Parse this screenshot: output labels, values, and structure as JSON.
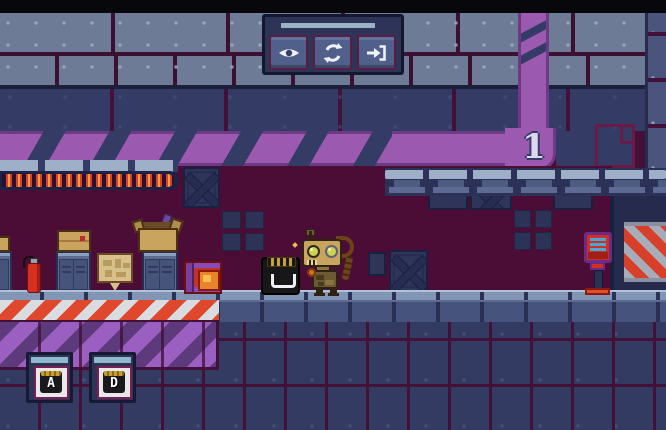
{
  "app": {
    "name": "pixel-platformer-level",
    "level_indicator": "1"
  },
  "hud": {
    "buttons": [
      {
        "id": "toggle-visibility",
        "icon": "eye-icon"
      },
      {
        "id": "restart-level",
        "icon": "restart-icon"
      },
      {
        "id": "exit-level",
        "icon": "exit-icon"
      }
    ]
  },
  "key_hints": {
    "keys": [
      "A",
      "D"
    ]
  },
  "palette": {
    "room_background": "#4b0d35",
    "wall_plates": "#6e7b96",
    "wall_panels": "#343b64",
    "beam_purple": "#9c59b0",
    "hazard_red": "#d8402c",
    "hazard_grey": "#a7adb8",
    "floor_blue": "#46537d",
    "rail_light": "#9db0c8",
    "robot_tan": "#c9a45f",
    "glow_orange": "#f5a03a",
    "level_number_color": "#ded6ec"
  }
}
